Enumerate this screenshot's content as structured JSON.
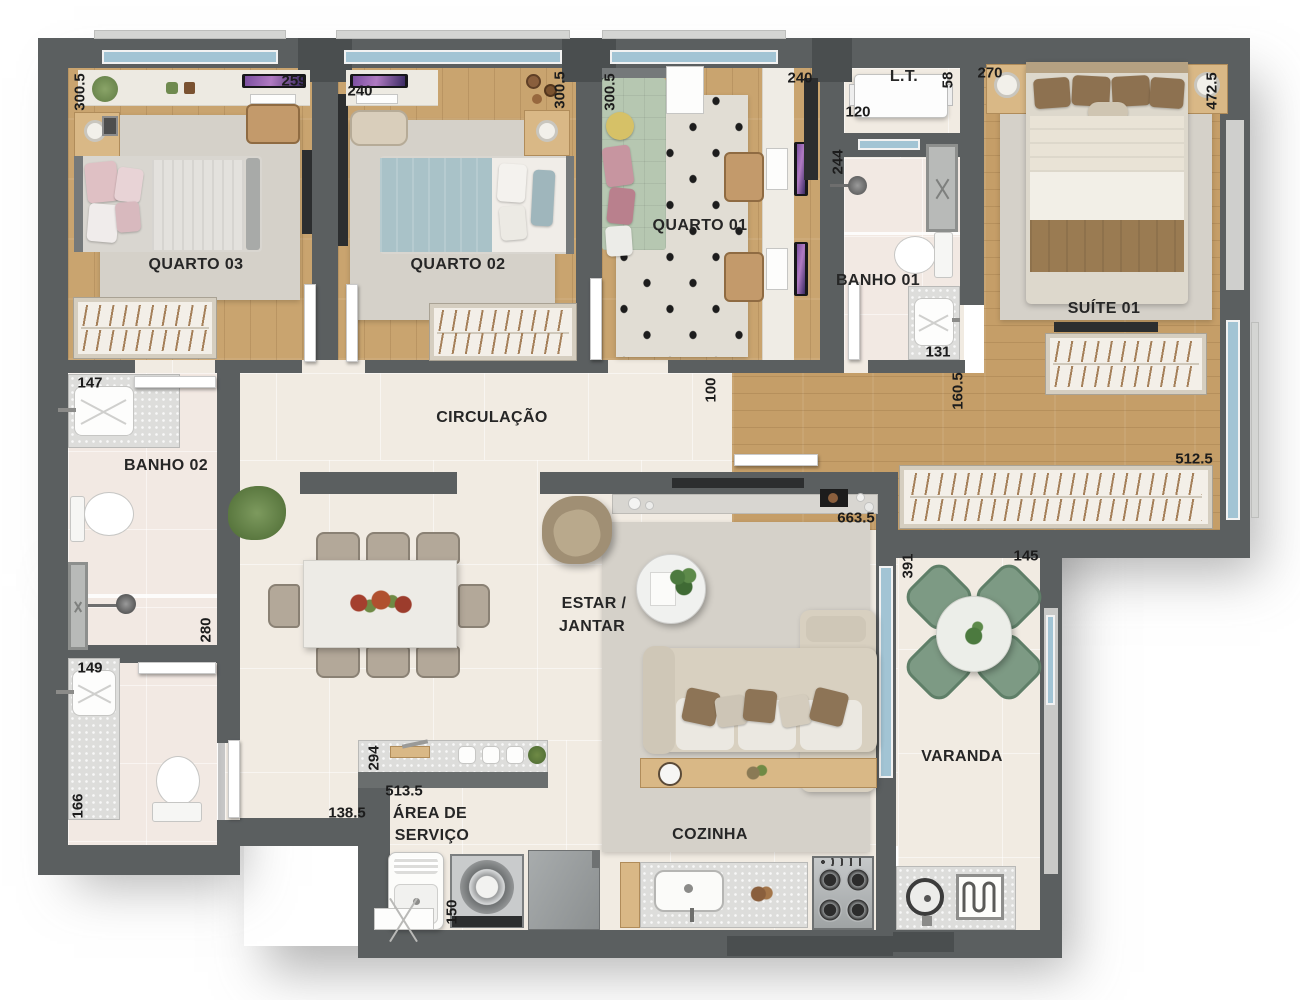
{
  "palette": {
    "wall": "#5b5f60",
    "floor_tile": "#f1ebe2",
    "floor_wood": "#c9a46f",
    "window_glass": "#a2c4d4",
    "bed_suite_blanket": "#9a7b52",
    "bed_q2_duvet": "#a9c2c8",
    "bed_q1_mattress": "#b6c7b1",
    "varanda_chairs": "#7d9a84"
  },
  "rooms": {
    "quarto03": {
      "label": "QUARTO 03",
      "dim_side": "300.5",
      "dim_desk": "259"
    },
    "quarto02": {
      "label": "QUARTO 02",
      "dim_top": "240",
      "dim_side": "300.5"
    },
    "quarto01": {
      "label": "QUARTO 01",
      "dim_side": "300.5",
      "dim_top": "240"
    },
    "lt": {
      "label": "L.T.",
      "dim_width": "120",
      "dim_depth": "58"
    },
    "banho01": {
      "label": "BANHO 01",
      "dim_depth": "244",
      "dim_width": "131"
    },
    "suite01": {
      "label": "SUÍTE 01",
      "dim_head": "270",
      "dim_side": "472.5",
      "dim_hall": "160.5",
      "dim_closet": "512.5"
    },
    "banho02": {
      "label": "BANHO 02",
      "dim_top": "147",
      "dim_depth": "280"
    },
    "circulacao": {
      "label": "CIRCULAÇÃO",
      "dim_opening": "100"
    },
    "estar": {
      "label_line1": "ESTAR /",
      "label_line2": "JANTAR",
      "dim_width": "663.5"
    },
    "varanda": {
      "label": "VARANDA",
      "dim_depth": "391",
      "dim_width": "145"
    },
    "lavabo": {
      "dim_top": "149",
      "dim_side": "166"
    },
    "servico": {
      "label_line1": "ÁREA DE",
      "label_line2": "SERVIÇO",
      "dim_island": "294",
      "dim_top": "513.5",
      "dim_left": "138.5",
      "dim_bottom": "150"
    },
    "cozinha": {
      "label": "COZINHA"
    }
  }
}
